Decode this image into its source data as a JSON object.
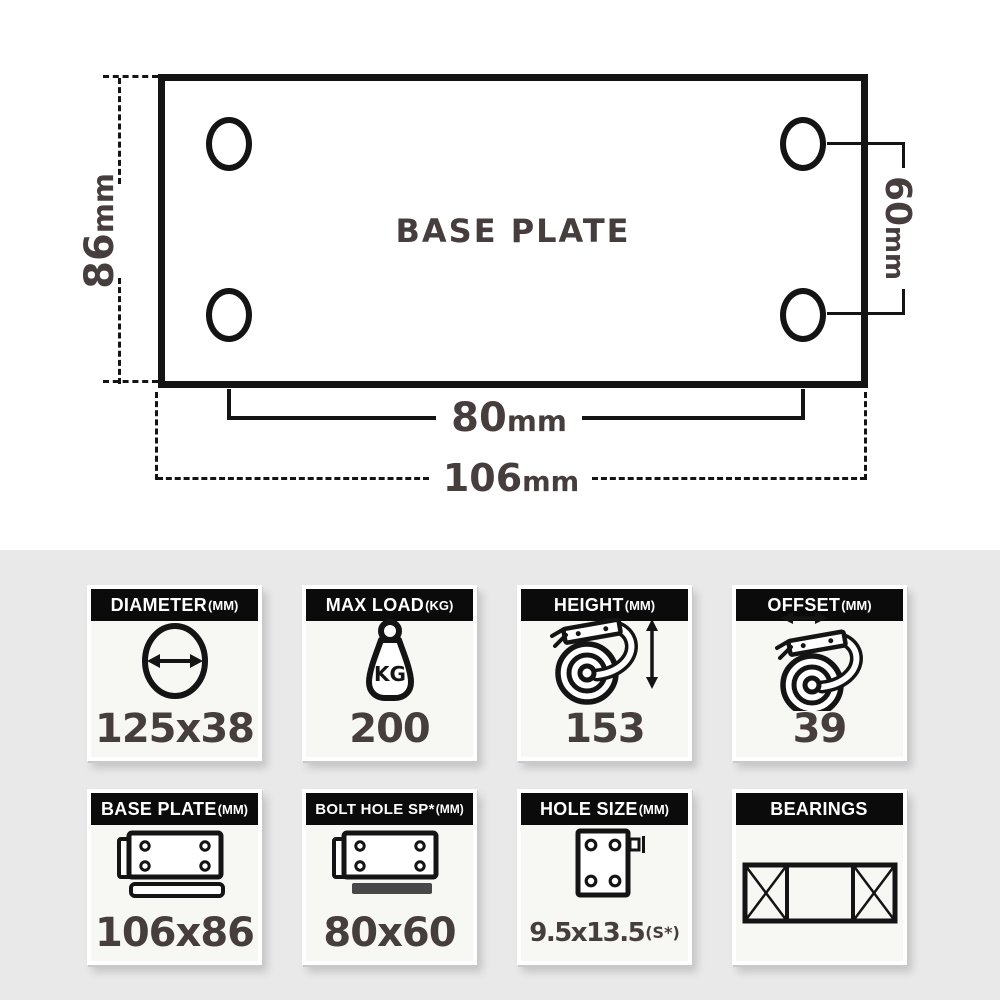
{
  "diagram": {
    "plate_label": "BASE PLATE",
    "dims": {
      "left": {
        "num": "86",
        "unit": "mm"
      },
      "right": {
        "num": "60",
        "unit": "mm"
      },
      "bolt_spacing": {
        "num": "80",
        "unit": "mm"
      },
      "plate_width": {
        "num": "106",
        "unit": "mm"
      }
    },
    "line_color": "#141414",
    "text_color": "#463d3d"
  },
  "specs": {
    "section_bg": "#e9e9e9",
    "header_bg": "#0b0b0b",
    "header_text_color": "#ffffff",
    "value_color": "#463d3d",
    "cards": [
      {
        "label": "DIAMETER",
        "unit": "(MM)",
        "value": "125x38",
        "icon": "diameter-arrow-circle-icon"
      },
      {
        "label": "MAX LOAD",
        "unit": "(KG)",
        "value": "200",
        "icon": "kg-weight-icon"
      },
      {
        "label": "HEIGHT",
        "unit": "(MM)",
        "value": "153",
        "icon": "caster-height-arrow-icon"
      },
      {
        "label": "OFFSET",
        "unit": "(MM)",
        "value": "39",
        "icon": "caster-offset-arrow-icon"
      },
      {
        "label": "BASE PLATE",
        "unit": "(MM)",
        "value": "106x86",
        "icon": "base-plate-icon"
      },
      {
        "label": "BOLT HOLE SP*",
        "unit": "(MM)",
        "value": "80x60",
        "icon": "bolt-hole-spacing-icon"
      },
      {
        "label": "HOLE SIZE",
        "unit": "(MM)",
        "value": "9.5x13.5",
        "value_suffix": "(S*)",
        "icon": "hole-size-icon"
      },
      {
        "label": "BEARINGS",
        "unit": "",
        "value": "",
        "icon": "roller-bearing-icon"
      }
    ]
  }
}
